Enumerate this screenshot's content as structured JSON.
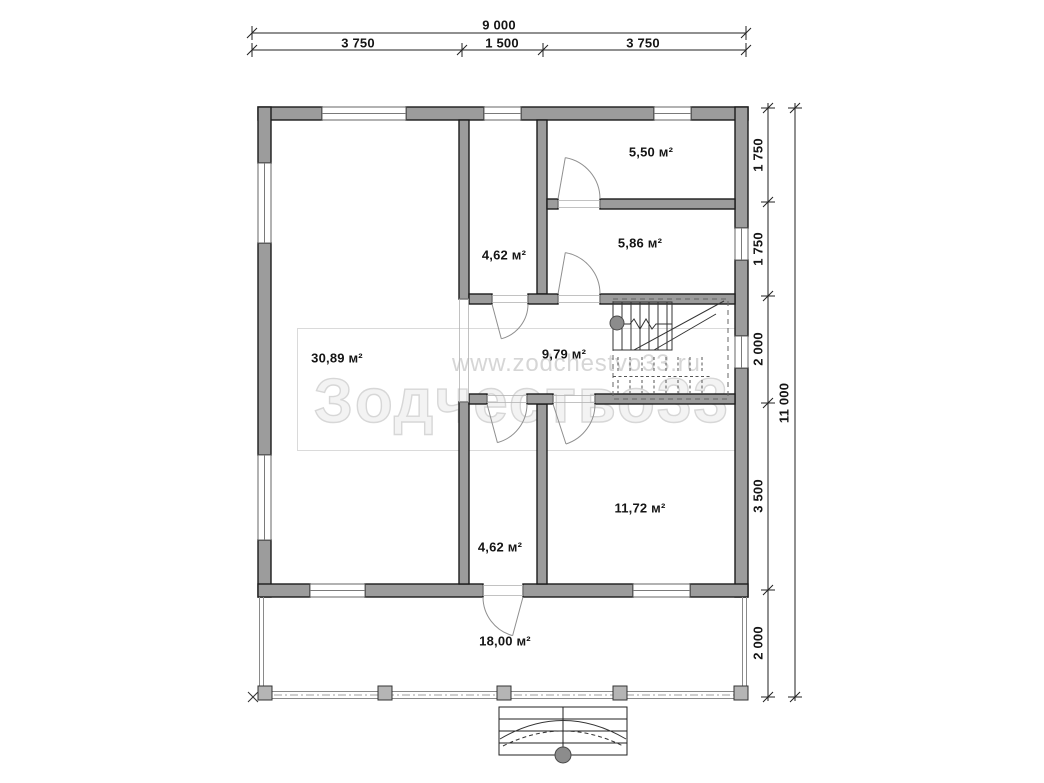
{
  "drawing": {
    "type": "floor-plan",
    "area_unit": "м²"
  },
  "dimensions": {
    "top": {
      "total": "9 000",
      "segments": [
        "3 750",
        "1 500",
        "3 750"
      ]
    },
    "right": {
      "total": "11 000",
      "segments": [
        "1 750",
        "1 750",
        "2 000",
        "3 500",
        "2 000"
      ]
    }
  },
  "rooms": [
    {
      "id": "room-top-right-upper",
      "area": "5,50 м²"
    },
    {
      "id": "room-top-right-lower",
      "area": "5,86 м²"
    },
    {
      "id": "room-top-center",
      "area": "4,62 м²"
    },
    {
      "id": "room-left-living",
      "area": "30,89 м²"
    },
    {
      "id": "hall-with-stairs",
      "area": "9,79 м²"
    },
    {
      "id": "room-bottom-right",
      "area": "11,72 м²"
    },
    {
      "id": "room-bottom-center",
      "area": "4,62 м²"
    },
    {
      "id": "terrace",
      "area": "18,00 м²"
    }
  ],
  "watermark": {
    "url": "www.zodchestvo33.ru",
    "brand": "Зодчество33"
  },
  "colors": {
    "wall_fill": "#9c9c9c",
    "outline": "#1c1c1c",
    "watermark": "#d7d7d7",
    "column_dot": "#8c8c8c",
    "post_fill": "#b5b5b5"
  }
}
